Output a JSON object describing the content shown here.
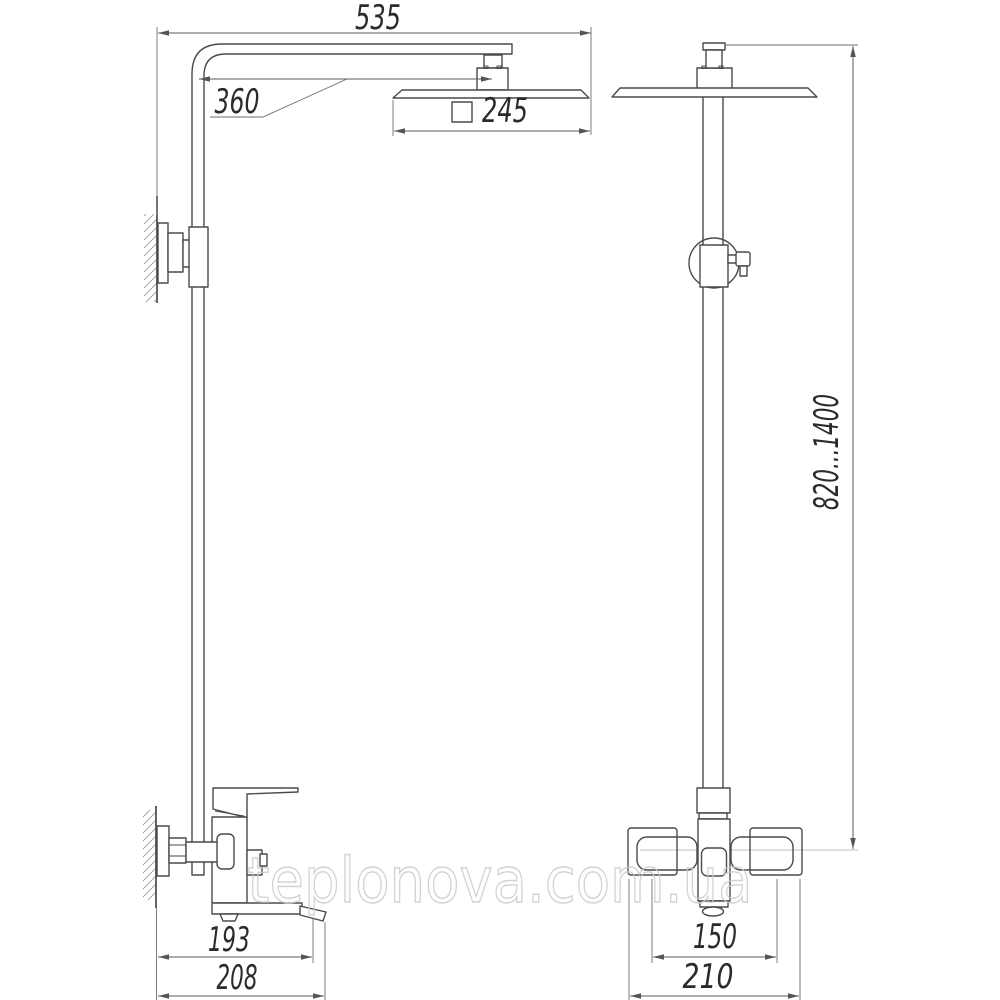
{
  "watermark": {
    "text": "teplonova.com.ua"
  },
  "views": {
    "side": {
      "dims": {
        "overall_width_mm": "535",
        "arm_reach_mm": "360",
        "head_size_mm": "245",
        "spout_projection_mm": "193",
        "overall_depth_mm": "208"
      }
    },
    "front": {
      "dims": {
        "height_range_mm": "820...1400",
        "inlet_centers_mm": "150",
        "body_width_mm": "210"
      }
    }
  }
}
